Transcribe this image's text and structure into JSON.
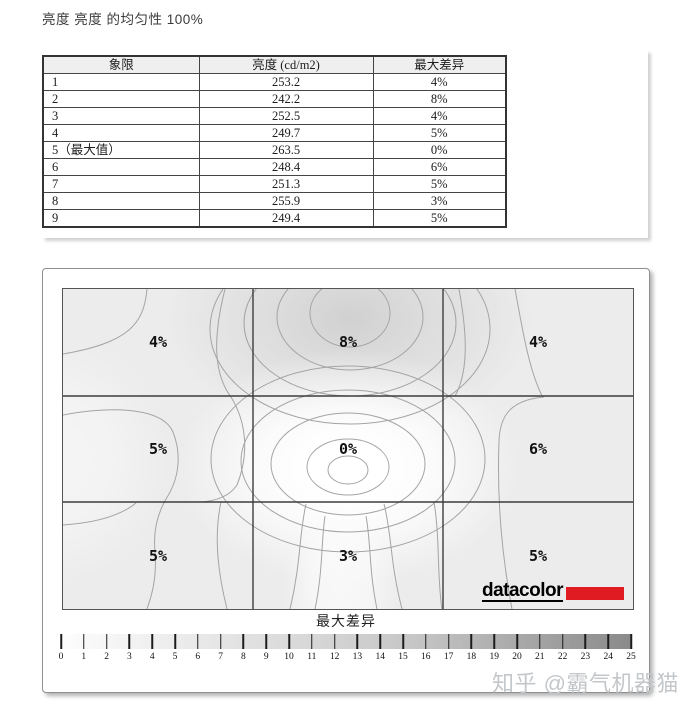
{
  "page_title": "亮度 亮度 的均匀性 100%",
  "watermark": "知乎 @霸气机器猫",
  "colors": {
    "datacolor_red": "#e11b22",
    "plot_background": "#ececec",
    "colorbar_start": "#ffffff",
    "colorbar_end": "#8a8a8a"
  },
  "chart_data": [
    {
      "type": "table",
      "title": "亮度 亮度 的均匀性 100%",
      "columns": [
        "象限",
        "亮度 (cd/m2)",
        "最大差异"
      ],
      "rows": [
        [
          "1",
          253.2,
          "4%"
        ],
        [
          "2",
          242.2,
          "8%"
        ],
        [
          "3",
          252.5,
          "4%"
        ],
        [
          "4",
          249.7,
          "5%"
        ],
        [
          "5（最大值）",
          263.5,
          "0%"
        ],
        [
          "6",
          248.4,
          "6%"
        ],
        [
          "7",
          251.3,
          "5%"
        ],
        [
          "8",
          255.9,
          "3%"
        ],
        [
          "9",
          249.4,
          "5%"
        ]
      ]
    },
    {
      "type": "heatmap",
      "title": "最大差异",
      "grid": {
        "rows": 3,
        "cols": 3
      },
      "cell_labels": [
        [
          "4%",
          "8%",
          "4%"
        ],
        [
          "5%",
          "0%",
          "6%"
        ],
        [
          "5%",
          "3%",
          "5%"
        ]
      ],
      "cell_values_percent": [
        [
          4,
          8,
          4
        ],
        [
          5,
          0,
          6
        ],
        [
          5,
          3,
          5
        ]
      ],
      "colorbar": {
        "label": "最大差异",
        "min": 0,
        "max": 25,
        "ticks": [
          0,
          1,
          2,
          3,
          4,
          5,
          6,
          7,
          8,
          9,
          10,
          11,
          12,
          13,
          14,
          15,
          16,
          17,
          18,
          19,
          20,
          21,
          22,
          23,
          24,
          25
        ]
      },
      "logo_text": "datacolor",
      "legend_position": "bottom",
      "notes": "3x3 luminance-uniformity contour map; darkest region top-center (8%), brightest at center (0%)"
    }
  ]
}
